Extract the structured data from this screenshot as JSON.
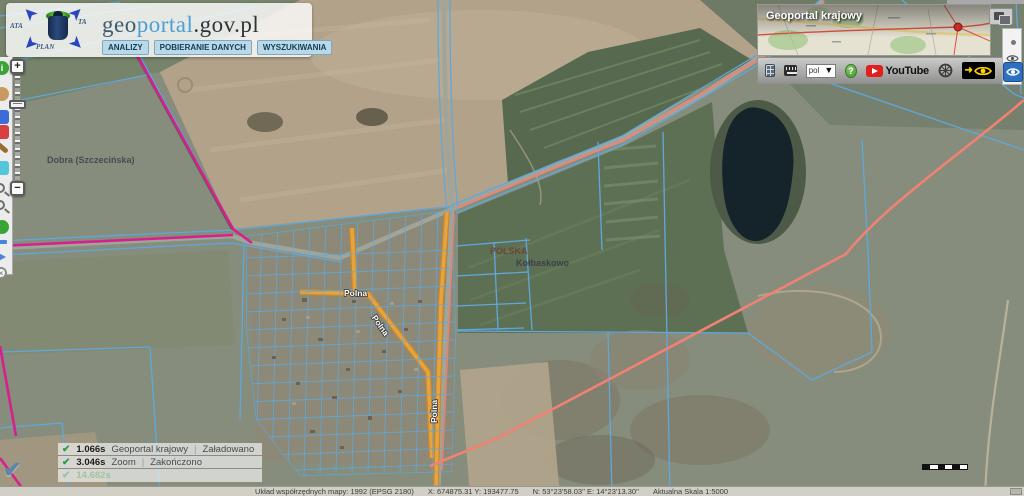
{
  "header": {
    "logo": {
      "fragments": [
        "ATA",
        "TA",
        "PLAN"
      ],
      "title_geo": "geo",
      "title_portal": "portal",
      "title_suffix": ".gov.pl"
    },
    "menu": [
      {
        "label": "ANALIZY"
      },
      {
        "label": "POBIERANIE DANYCH"
      },
      {
        "label": "WYSZUKIWANIA"
      }
    ]
  },
  "left_toolbar": {
    "tools": [
      "info",
      "hand",
      "blue-flag",
      "red-flag",
      "pencil",
      "layers",
      "zoom-in",
      "zoom-out",
      "globe",
      "measure",
      "send",
      "clear"
    ]
  },
  "zoom_control": {
    "zoom_in_label": "+",
    "zoom_out_label": "−"
  },
  "overview_panel": {
    "title": "Geoportal krajowy"
  },
  "top_toolbar": {
    "language_selected": "pol",
    "help_label": "?",
    "youtube_label": "YouTube",
    "contrast_arrow": "➜"
  },
  "map_labels": {
    "region": "Dobra (Szczecińska)",
    "country": "POLSKA",
    "town": "Kołbaskowo",
    "street": "Polna"
  },
  "status_toasts": [
    {
      "time": "1.066s",
      "source": "Geoportal krajowy",
      "status": "Załadowano"
    },
    {
      "time": "3.046s",
      "source": "Zoom",
      "status": "Zakończono"
    },
    {
      "time": "14.682s",
      "source": "",
      "status": ""
    }
  ],
  "status_bar": {
    "crs": "Układ współrzędnych mapy: 1992 (EPSG 2180)",
    "coords_xy": "X: 674875.31  Y: 193477.75",
    "coords_geo": "N: 53°23'58.03''  E: 14°23'13.30''",
    "scale": "Aktualna Skala 1:5000"
  },
  "colors": {
    "parcel_blue": "#5fa8dc",
    "road_orange": "#e8a33d",
    "road_orange_edge": "#c8882e",
    "boundary_magenta": "#d6208e",
    "overlay_salmon": "#ef8273",
    "youtube_red": "#e02020",
    "help_green": "#57a33f",
    "accessibility_yellow": "#ffd400",
    "eye_blue": "#2f6fc1"
  }
}
